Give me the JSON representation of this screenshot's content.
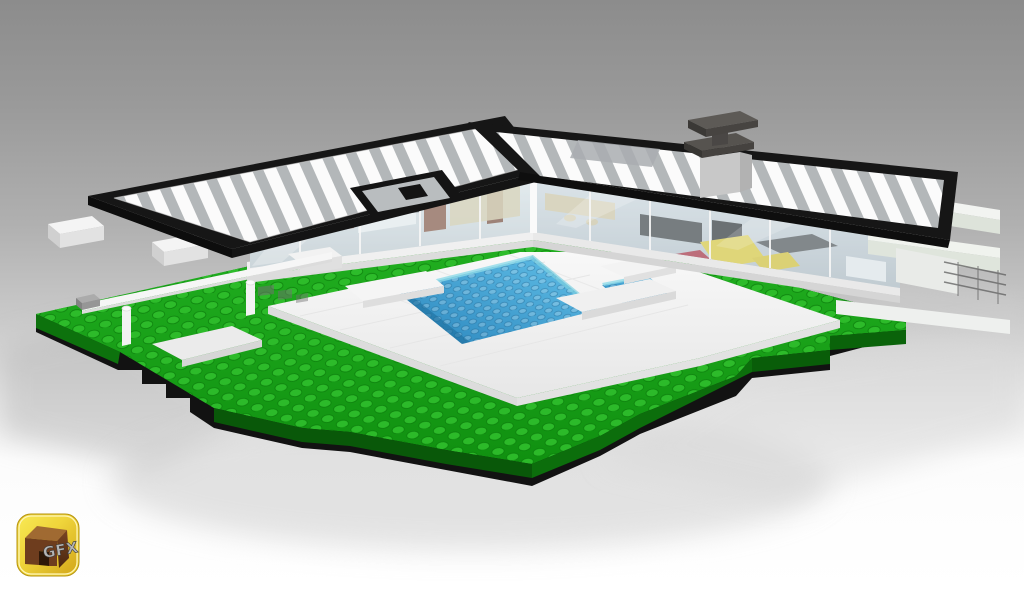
{
  "logo": {
    "text": "GFX"
  },
  "colors": {
    "background_top": "#8c8c8c",
    "background_bottom": "#ffffff",
    "roof_black": "#161616",
    "roof_stripe_white": "#fbfbfb",
    "roof_stripe_gray": "#b3b7b9",
    "chimney_dark": "#56534f",
    "chimney_gray": "#c8c8c8",
    "glass_tint": "#d9ecf2",
    "wall_white": "#f0f0f0",
    "terrace_white": "#f3f3f3",
    "pool_blue": "#2b86bd",
    "pool_blue_light": "#5fb9e3",
    "grass_green": "#1aa51a",
    "grass_green_dark": "#0b6b0b",
    "foundation_black": "#121212",
    "beam_white": "#f2f4f1",
    "furniture_brown": "#8a5743",
    "furniture_tan": "#d9cba6",
    "furniture_yellow": "#e5ce42",
    "furniture_red": "#b23545",
    "furniture_gray": "#4c4c4c",
    "fence_white": "#f6f6f6",
    "rock_gray": "#ababab",
    "logo_gold": "#f0d63c",
    "logo_brown": "#6e3d1e",
    "logo_text_gray": "#b5b5b5"
  }
}
